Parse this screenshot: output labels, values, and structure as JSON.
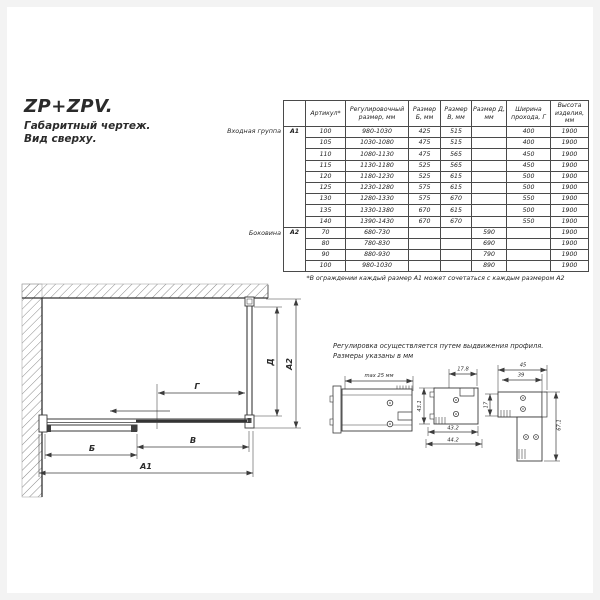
{
  "header": {
    "title": "ZP+ZPV.",
    "line2": "Габаритный чертеж.",
    "line3": "Вид сверху."
  },
  "table": {
    "headers": [
      "Артикул*",
      "Регулировочный размер, мм",
      "Размер Б, мм",
      "Размер В, мм",
      "Размер Д, мм",
      "Ширина прохода, Г",
      "Высота изделия, мм"
    ],
    "groups": [
      {
        "label": "Входная группа",
        "code": "А1",
        "rows": [
          [
            "100",
            "980-1030",
            "425",
            "515",
            "",
            "400",
            "1900"
          ],
          [
            "105",
            "1030-1080",
            "475",
            "515",
            "",
            "400",
            "1900"
          ],
          [
            "110",
            "1080-1130",
            "475",
            "565",
            "",
            "450",
            "1900"
          ],
          [
            "115",
            "1130-1180",
            "525",
            "565",
            "",
            "450",
            "1900"
          ],
          [
            "120",
            "1180-1230",
            "525",
            "615",
            "",
            "500",
            "1900"
          ],
          [
            "125",
            "1230-1280",
            "575",
            "615",
            "",
            "500",
            "1900"
          ],
          [
            "130",
            "1280-1330",
            "575",
            "670",
            "",
            "550",
            "1900"
          ],
          [
            "135",
            "1330-1380",
            "670",
            "615",
            "",
            "500",
            "1900"
          ],
          [
            "140",
            "1390-1430",
            "670",
            "670",
            "",
            "550",
            "1900"
          ]
        ]
      },
      {
        "label": "Боковина",
        "code": "А2",
        "rows": [
          [
            "70",
            "680-730",
            "",
            "",
            "590",
            "",
            "1900"
          ],
          [
            "80",
            "780-830",
            "",
            "",
            "690",
            "",
            "1900"
          ],
          [
            "90",
            "880-930",
            "",
            "",
            "790",
            "",
            "1900"
          ],
          [
            "100",
            "980-1030",
            "",
            "",
            "890",
            "",
            "1900"
          ]
        ]
      }
    ],
    "footnote": "*В ограждении каждый размер А1 может сочетаться с каждым размером А2"
  },
  "plan": {
    "labels": {
      "b": "Б",
      "v": "В",
      "g": "Г",
      "a1": "А1",
      "a2": "А2",
      "d": "Д"
    }
  },
  "profiles": {
    "note1": "Регулировка осуществляется путем выдвижения профиля.",
    "note2": "Размеры указаны в мм",
    "details": {
      "wall": {
        "max": "max 25 мм"
      },
      "guide": {
        "top": "17.8",
        "left": "43.1",
        "inner": "43.2",
        "outer": "44.2"
      },
      "corner": {
        "top": "45",
        "second": "39",
        "left": "17",
        "right": "67.1"
      }
    }
  },
  "colors": {
    "line": "#3a3a3a",
    "text": "#2b2b2b",
    "hatch": "#8a8a8a",
    "frame": "#f3f3f3",
    "page": "#ffffff"
  }
}
